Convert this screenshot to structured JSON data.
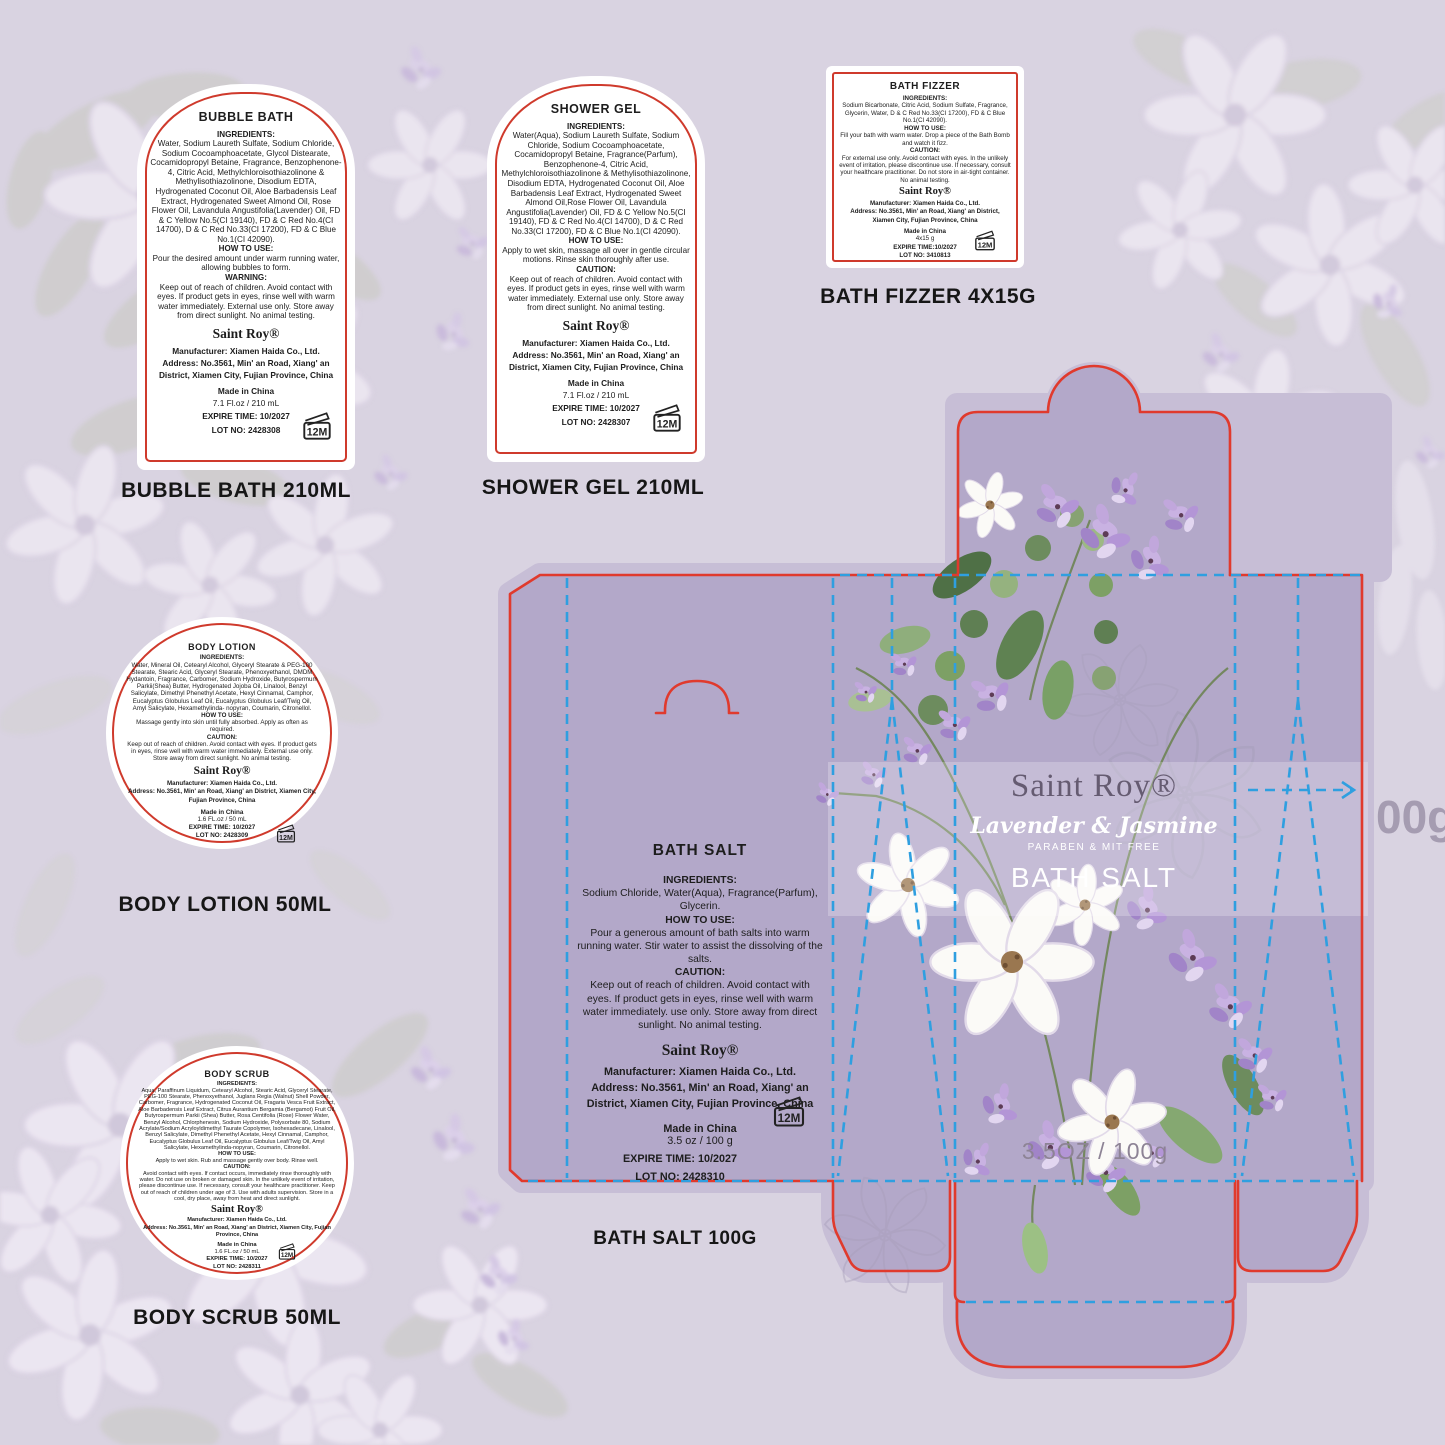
{
  "colors": {
    "page_bg": "#d9d3e1",
    "bleed": "#c7bed6",
    "panel": "#b3a8c9",
    "cut_line": "#e03a2d",
    "fold_line": "#2f9fe0",
    "label_bg": "#ffffff",
    "label_border": "#cf3a2c",
    "caption": "#161616",
    "brand_on_box": "#655b71",
    "band_text": "#ffffff",
    "net_text": "#8d8395",
    "edge_text": "#9c92a8"
  },
  "products": [
    {
      "title": "BUBBLE BATH",
      "sections": [
        {
          "heading": "INGREDIENTS:",
          "text": "Water, Sodium Laureth Sulfate, Sodium Chloride, Sodium Cocoamphoacetate, Glycol Distearate, Cocamidopropyl Betaine, Fragrance, Benzophenone-4, Citric Acid, Methylchloroisothiazolinone & Methylisothiazolinone, Disodium EDTA, Hydrogenated Coconut Oil, Aloe Barbadensis Leaf Extract, Hydrogenated Sweet Almond Oil, Rose Flower Oil, Lavandula Angustifolia(Lavender) Oil, FD & C Yellow No.5(CI 19140), FD & C Red No.4(CI 14700), D & C Red No.33(CI 17200), FD & C Blue No.1(CI 42090)."
        },
        {
          "heading": "HOW TO USE:",
          "text": "Pour the desired amount under warm running water, allowing bubbles to form."
        },
        {
          "heading": "WARNING:",
          "text": "Keep out of reach of children. Avoid contact with eyes. If product gets in eyes, rinse well with warm water immediately. External use only. Store away from direct sunlight. No animal testing."
        }
      ],
      "brand": "Saint Roy®",
      "manufacturer": "Manufacturer: Xiamen Haida Co., Ltd.",
      "address": "Address: No.3561, Min' an Road, Xiang' an District, Xiamen City, Fujian Province, China",
      "made_in": "Made in China",
      "size": "7.1 Fl.oz / 210 mL",
      "expire": "EXPIRE TIME: 10/2027",
      "lot": "LOT NO: 2428308",
      "period_after_opening": "12M",
      "caption": "BUBBLE BATH 210ML"
    },
    {
      "title": "SHOWER GEL",
      "sections": [
        {
          "heading": "INGREDIENTS:",
          "text": "Water(Aqua), Sodium Laureth Sulfate, Sodium Chloride, Sodium Cocoamphoacetate, Cocamidopropyl Betaine, Fragrance(Parfum), Benzophenone-4, Citric Acid, Methylchloroisothiazolinone & Methylisothiazolinone, Disodium EDTA, Hydrogenated Coconut Oil, Aloe Barbadensis Leaf Extract, Hydrogenated Sweet Almond Oil,Rose Flower Oil, Lavandula Angustifolia(Lavender) Oil, FD & C Yellow No.5(CI 19140), FD & C Red No.4(CI 14700), D & C Red No.33(CI 17200), FD & C Blue No.1(CI 42090)."
        },
        {
          "heading": "HOW TO USE:",
          "text": "Apply to wet skin, massage all over in gentle circular motions. Rinse skin thoroughly after use."
        },
        {
          "heading": "CAUTION:",
          "text": "Keep out of reach of children. Avoid contact with eyes. If product gets in eyes, rinse well with warm water immediately. External use only. Store away from direct sunlight. No animal testing."
        }
      ],
      "brand": "Saint Roy®",
      "manufacturer": "Manufacturer: Xiamen Haida Co., Ltd.",
      "address": "Address: No.3561, Min' an Road, Xiang' an District, Xiamen City, Fujian Province, China",
      "made_in": "Made in China",
      "size": "7.1 Fl.oz / 210 mL",
      "expire": "EXPIRE TIME: 10/2027",
      "lot": "LOT NO: 2428307",
      "period_after_opening": "12M",
      "caption": "SHOWER GEL  210ML"
    },
    {
      "title": "BATH FIZZER",
      "sections": [
        {
          "heading": "INGREDIENTS:",
          "text": "Sodium Bicarbonate, Citric Acid, Sodium Sulfate, Fragrance, Glycerin, Water, D & C Red No.33(CI 17200), FD & C Blue No.1(CI 42090)."
        },
        {
          "heading": "HOW TO USE:",
          "text": "Fill your bath with warm water. Drop a piece of the Bath Bomb and watch it fizz."
        },
        {
          "heading": "CAUTION:",
          "text": "For external use only. Avoid contact with eyes. In the unlikely event of irritation, please discontinue use. If necessary, consult your healthcare practitioner. Do not store in air-tight container. No animal testing."
        }
      ],
      "brand": "Saint Roy®",
      "manufacturer": "Manufacturer: Xiamen Haida Co., Ltd.",
      "address": "Address: No.3561, Min' an Road, Xiang' an District, Xiamen City, Fujian Province, China",
      "made_in": "Made in China",
      "size": "4x15 g",
      "expire": "EXPIRE TIME:10/2027",
      "lot": "LOT NO: 3410813",
      "period_after_opening": "12M",
      "caption": "BATH FIZZER 4X15G"
    },
    {
      "title": "BODY LOTION",
      "sections": [
        {
          "heading": "INGREDIENTS:",
          "text": "Water, Mineral Oil, Cetearyl Alcohol, Glyceryl Stearate & PEG-100 Stearate, Stearic Acid, Glyceryl Stearate, Phenoxyethanol, DMDM Hydantoin, Fragrance, Carbomer, Sodium Hydroxide, Butyrospermum Parkii(Shea) Butter, Hydrogenated Jojoba Oil, Linalool, Benzyl Salicylate, Dimethyl Phenethyl Acetate, Hexyl Cinnamal, Camphor, Eucalyptus Globulus Leaf Oil, Eucalyptus Globulus Leaf/Twig Oil, Amyl Salicylate, Hexamethylinda- nopyran, Coumarin, Citronellol."
        },
        {
          "heading": "HOW TO USE:",
          "text": "Massage gently into skin until fully absorbed. Apply as often as required."
        },
        {
          "heading": "CAUTION:",
          "text": "Keep out of reach of children. Avoid contact with eyes. If product gets in eyes, rinse well with warm water immediately. External use only. Store away from direct sunlight. No animal testing."
        }
      ],
      "brand": "Saint Roy®",
      "manufacturer": "Manufacturer: Xiamen Haida Co., Ltd.",
      "address": "Address: No.3561, Min' an Road, Xiang' an District, Xiamen City, Fujian Province, China",
      "made_in": "Made in China",
      "size": "1.6 FL.oz / 50 mL",
      "expire": "EXPIRE TIME: 10/2027",
      "lot": "LOT NO: 2428309",
      "period_after_opening": "12M",
      "caption": "BODY LOTION 50ML"
    },
    {
      "title": "BODY SCRUB",
      "sections": [
        {
          "heading": "INGREDIENTS:",
          "text": "Aqua, Paraffinum Liquidum, Cetearyl Alcohol, Stearic Acid, Glyceryl Stearate, PEG-100 Stearate, Phenoxyethanol, Juglans Regia (Walnut) Shell Powder, Carbomer, Fragrance, Hydrogenated Coconut Oil, Fragaria Vesca Fruit Extract, Aloe Barbadensis Leaf Extract, Citrus Aurantium Bergamia (Bergamot) Fruit Oil, Butyrospermum Parkii (Shea) Butter, Rosa Centifolia (Rose) Flower Water, Benzyl Alcohol, Chlorphenesin, Sodium Hydroxide, Polysorbate 80, Sodium Acrylate/Sodium Acryloyldimethyl Taurate Copolymer, Isohexadecane, Linalool, Benzyl Salicylate, Dimethyl Phenethyl Acetate, Hexyl Cinnamal, Camphor, Eucalyptus Globulus Leaf Oil, Eucalyptus Globulus Leaf/Twig Oil, Amyl Salicylate, Hexamethylinda-nopyran, Coumarin, Citronellol."
        },
        {
          "heading": "HOW TO USE:",
          "text": "Apply to wet skin. Rub and massage gently over body. Rinse well."
        },
        {
          "heading": "CAUTION:",
          "text": "Avoid contact with eyes. If contact occurs, immediately rinse thoroughly with water. Do not use on broken or damaged skin. In the unlikely event of irritation, please discontinue use. If necessary, consult your healthcare practitioner. Keep out of reach of children under age of 3. Use with adults supervision. Store in a cool, dry place, away from heat and direct sunlight."
        }
      ],
      "brand": "Saint Roy®",
      "manufacturer": "Manufacturer: Xiamen Haida Co., Ltd.",
      "address": "Address: No.3561, Min' an Road, Xiang' an District, Xiamen City, Fujian Province, China",
      "made_in": "Made in China",
      "size": "1.6 FL.oz / 50 mL",
      "expire": "EXPIRE TIME: 10/2027",
      "lot": "LOT NO: 2428311",
      "period_after_opening": "12M",
      "caption": "BODY SCRUB 50ML"
    }
  ],
  "box": {
    "brand": "Saint Roy®",
    "scent": "Lavender & Jasmine",
    "claim": "PARABEN & MIT FREE",
    "product_name": "BATH SALT",
    "net": "3.5OZ / 100g",
    "edge_text": "00g",
    "caption": "BATH SALT  100G",
    "panel": {
      "title": "BATH SALT",
      "sections": [
        {
          "heading": "INGREDIENTS:",
          "text": "Sodium Chloride, Water(Aqua), Fragrance(Parfum), Glycerin."
        },
        {
          "heading": "HOW TO USE:",
          "text": "Pour a generous amount of bath salts into warm running water. Stir water to assist the dissolving of the salts."
        },
        {
          "heading": "CAUTION:",
          "text": "Keep out of reach of children. Avoid contact with eyes. If product gets in eyes, rinse well with warm water immediately. use only. Store away from direct sunlight. No animal testing."
        }
      ],
      "brand": "Saint Roy®",
      "manufacturer": "Manufacturer: Xiamen Haida Co., Ltd.",
      "address": "Address: No.3561, Min' an Road, Xiang' an District, Xiamen City, Fujian Province, China",
      "made_in": "Made in China",
      "size": "3.5 oz / 100 g",
      "expire": "EXPIRE TIME: 10/2027",
      "lot": "LOT NO: 2428310",
      "period_after_opening": "12M"
    }
  }
}
